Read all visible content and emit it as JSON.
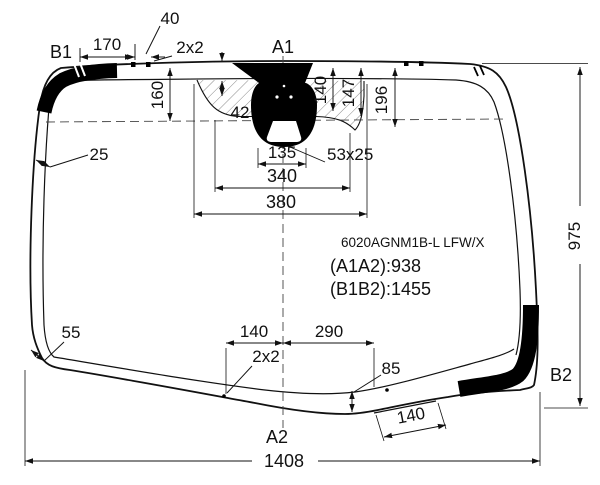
{
  "diagram": {
    "title_block": {
      "part_code": "6020AGNM1B-L LFW/X",
      "a1a2": "(A1A2):938",
      "b1b2": "(B1B2):1455"
    },
    "points": {
      "b1": "B1",
      "a1": "A1",
      "a2": "A2",
      "b2": "B2"
    },
    "dims": {
      "top_edge_offset": "170",
      "top_tick_gap": "40",
      "top_tick_size": "2x2",
      "shade_band_height": "160",
      "notch_depth": "42",
      "mirror_depth_1": "140",
      "mirror_depth_2": "147",
      "mirror_depth_3": "196",
      "side_band_width": "25",
      "bracket_width": "135",
      "sensor_size": "53x25",
      "notch_width_inner": "340",
      "notch_width_outer": "380",
      "glass_height": "975",
      "corner_band_width": "55",
      "bottom_offset_left": "140",
      "bottom_offset_right": "290",
      "bottom_tick_size": "2x2",
      "bottom_band_height": "85",
      "step_width": "140",
      "glass_width": "1408"
    },
    "colors": {
      "line": "#111111",
      "band": "#000000",
      "background": "#ffffff"
    }
  }
}
